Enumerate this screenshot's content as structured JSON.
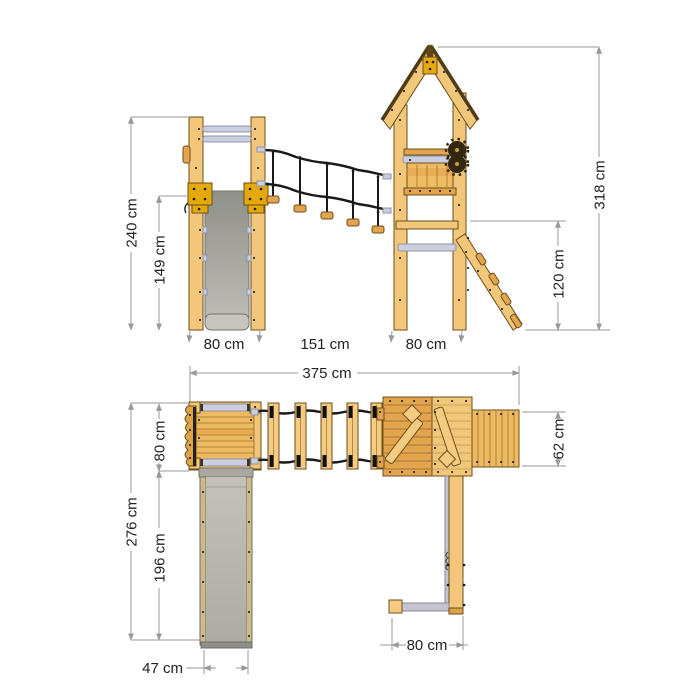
{
  "diagram": {
    "unit": "cm",
    "side_view": {
      "ladder_height": "240 cm",
      "slide_height": "149 cm",
      "tower_height": "318 cm",
      "ramp_height": "120 cm",
      "ladder_width": "80 cm",
      "bridge_span": "151 cm",
      "tower_width": "80 cm"
    },
    "plan_view": {
      "total_length": "375 cm",
      "platform_depth": "80 cm",
      "total_depth": "276 cm",
      "slide_length": "196 cm",
      "slide_width": "47 cm",
      "ramp_depth": "62 cm",
      "ramp_span": "80 cm"
    }
  },
  "colors": {
    "wood": "#F2C779",
    "wood_dark": "#E2A44C",
    "slide_gray": "#B2B2AA",
    "metal": "#CBCEDE",
    "rope": "#1A1A1A",
    "bracket_yellow": "#E5A90B",
    "dimension": "#999999",
    "text": "#222222"
  }
}
